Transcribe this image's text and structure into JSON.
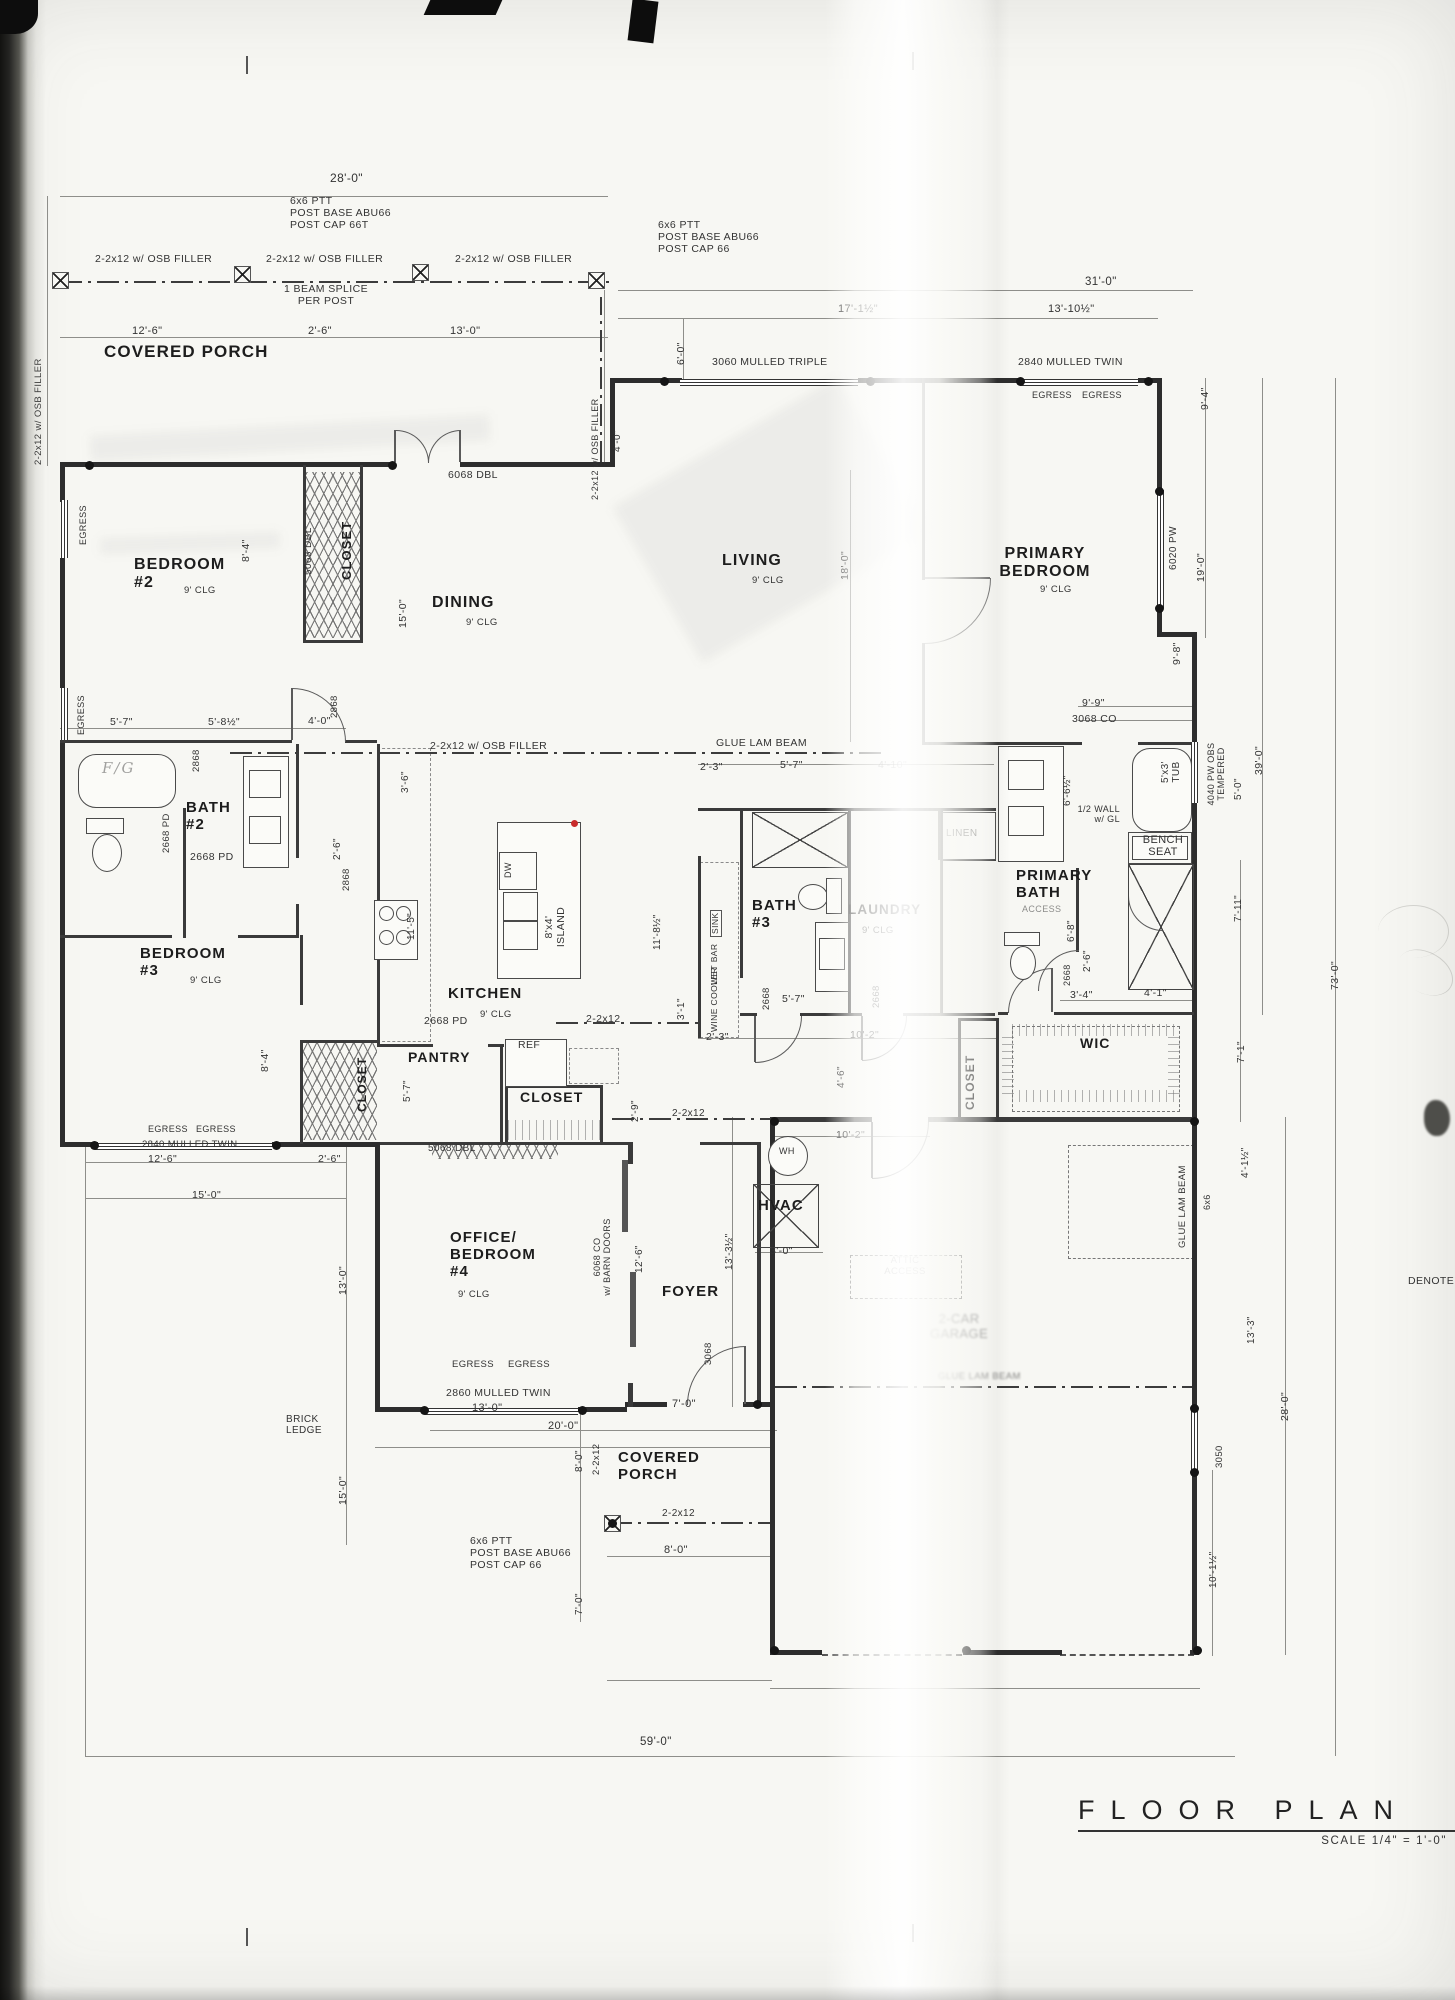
{
  "title_block": {
    "title": "FLOOR PLAN",
    "scale": "SCALE 1/4\" = 1'-0\""
  },
  "labels": [
    {
      "n": "dim-28-0",
      "t": "28'-0\"",
      "x": 330,
      "y": 172,
      "s": 12
    },
    {
      "n": "note-post-top-left",
      "t": "6x6 PTT\nPOST BASE ABU66\nPOST CAP 66T",
      "x": 290,
      "y": 196
    },
    {
      "n": "note-post-top-right",
      "t": "6x6 PTT\nPOST BASE ABU66\nPOST CAP 66",
      "x": 658,
      "y": 220
    },
    {
      "n": "note-osb-filler-1",
      "t": "2-2x12 w/ OSB FILLER",
      "x": 95,
      "y": 254
    },
    {
      "n": "note-osb-filler-2",
      "t": "2-2x12 w/ OSB FILLER",
      "x": 266,
      "y": 254
    },
    {
      "n": "note-osb-filler-3",
      "t": "2-2x12 w/ OSB FILLER",
      "x": 455,
      "y": 254
    },
    {
      "n": "note-beam-splice",
      "t": "1 BEAM SPLICE\nPER POST",
      "x": 278,
      "y": 284,
      "a": "center",
      "w": 96
    },
    {
      "n": "dim-31-0",
      "t": "31'-0\"",
      "x": 1085,
      "y": 276,
      "s": 11.5
    },
    {
      "n": "dim-17-1half",
      "t": "17'-1½\"",
      "x": 838,
      "y": 303,
      "s": 11
    },
    {
      "n": "dim-13-10half",
      "t": "13'-10½\"",
      "x": 1048,
      "y": 303,
      "s": 11
    },
    {
      "n": "room-covered-porch-top",
      "t": "COVERED PORCH",
      "x": 104,
      "y": 342,
      "s": 17,
      "c": "room"
    },
    {
      "n": "label-3060-mulled-triple",
      "t": "3060 MULLED TRIPLE",
      "x": 712,
      "y": 357
    },
    {
      "n": "label-2840-mulled-twin",
      "t": "2840 MULLED TWIN",
      "x": 1018,
      "y": 357
    },
    {
      "n": "label-egress-1",
      "t": "EGRESS",
      "x": 1032,
      "y": 390,
      "s": 9
    },
    {
      "n": "label-egress-2",
      "t": "EGRESS",
      "x": 1082,
      "y": 390,
      "s": 9
    },
    {
      "n": "dim-porch-12-6",
      "t": "12'-6\"",
      "x": 132,
      "y": 325,
      "s": 11
    },
    {
      "n": "dim-porch-2-6",
      "t": "2'-6\"",
      "x": 308,
      "y": 325,
      "s": 11
    },
    {
      "n": "dim-porch-13-0",
      "t": "13'-0\"",
      "x": 450,
      "y": 325,
      "s": 11
    },
    {
      "n": "label-6068-dbl",
      "t": "6068 DBL",
      "x": 448,
      "y": 470
    },
    {
      "n": "room-bedroom-2",
      "t": "BEDROOM\n#2",
      "x": 134,
      "y": 556,
      "s": 16,
      "c": "room"
    },
    {
      "n": "label-bedroom2-clg",
      "t": "9' CLG",
      "x": 184,
      "y": 586,
      "s": 9.5
    },
    {
      "n": "room-dining",
      "t": "DINING",
      "x": 432,
      "y": 594,
      "s": 16,
      "c": "room"
    },
    {
      "n": "label-dining-clg",
      "t": "9' CLG",
      "x": 466,
      "y": 618,
      "s": 9.5
    },
    {
      "n": "room-living",
      "t": "LIVING",
      "x": 722,
      "y": 552,
      "s": 16,
      "c": "room"
    },
    {
      "n": "label-living-clg",
      "t": "9' CLG",
      "x": 752,
      "y": 576,
      "s": 9.5
    },
    {
      "n": "room-primary-bedroom",
      "t": "PRIMARY\nBEDROOM",
      "x": 990,
      "y": 545,
      "s": 16,
      "c": "room",
      "a": "center",
      "w": 110
    },
    {
      "n": "label-primary-bedroom-clg",
      "t": "9' CLG",
      "x": 1040,
      "y": 585,
      "s": 9.5
    },
    {
      "n": "dim-5-7-bath2",
      "t": "5'-7\"",
      "x": 110,
      "y": 717
    },
    {
      "n": "dim-5-8half",
      "t": "5'-8½\"",
      "x": 208,
      "y": 717
    },
    {
      "n": "dim-4-0-bath2",
      "t": "4'-0\"",
      "x": 308,
      "y": 716
    },
    {
      "n": "label-glue-lam-beam-main",
      "t": "GLUE LAM BEAM",
      "x": 716,
      "y": 738
    },
    {
      "n": "note-osb-filler-mid",
      "t": "2-2x12 w/ OSB FILLER",
      "x": 430,
      "y": 741
    },
    {
      "n": "room-bath-2",
      "t": "BATH\n#2",
      "x": 186,
      "y": 800,
      "s": 15,
      "c": "room"
    },
    {
      "n": "label-2668-pd-h",
      "t": "2668 PD",
      "x": 190,
      "y": 852
    },
    {
      "n": "room-bedroom-3",
      "t": "BEDROOM\n#3",
      "x": 140,
      "y": 946,
      "s": 15,
      "c": "room"
    },
    {
      "n": "label-bedroom3-clg",
      "t": "9' CLG",
      "x": 190,
      "y": 976,
      "s": 9.5
    },
    {
      "n": "room-kitchen",
      "t": "KITCHEN",
      "x": 448,
      "y": 986,
      "s": 15,
      "c": "room"
    },
    {
      "n": "label-kitchen-clg",
      "t": "9' CLG",
      "x": 480,
      "y": 1010,
      "s": 9.5
    },
    {
      "n": "label-2668-pd-kitchen",
      "t": "2668 PD",
      "x": 424,
      "y": 1016
    },
    {
      "n": "label-2-2x12-kitchen",
      "t": "2-2x12",
      "x": 586,
      "y": 1014
    },
    {
      "n": "room-pantry",
      "t": "PANTRY",
      "x": 408,
      "y": 1050,
      "s": 14,
      "c": "room"
    },
    {
      "n": "label-ref",
      "t": "REF",
      "x": 518,
      "y": 1040
    },
    {
      "n": "room-closet-foyer",
      "t": "CLOSET",
      "x": 520,
      "y": 1090,
      "s": 14,
      "c": "room"
    },
    {
      "n": "label-5068-dbl-closet",
      "t": "5068 DBL",
      "x": 428,
      "y": 1143,
      "s": 10
    },
    {
      "n": "dim-2-3-a",
      "t": "2'-3\"",
      "x": 700,
      "y": 762
    },
    {
      "n": "dim-5-7-bath3",
      "t": "5'-7\"",
      "x": 780,
      "y": 760
    },
    {
      "n": "dim-4-10",
      "t": "4'-10\"",
      "x": 878,
      "y": 760,
      "c": "faint"
    },
    {
      "n": "room-bath-3",
      "t": "BATH\n#3",
      "x": 752,
      "y": 898,
      "s": 15,
      "c": "room"
    },
    {
      "n": "room-laundry",
      "t": "LAUNDRY",
      "x": 848,
      "y": 902,
      "s": 13.5,
      "c": "room"
    },
    {
      "n": "label-laundry-clg",
      "t": "9' CLG",
      "x": 862,
      "y": 926,
      "s": 9.5
    },
    {
      "n": "label-linen",
      "t": "LINEN",
      "x": 946,
      "y": 828,
      "s": 10,
      "c": "faint"
    },
    {
      "n": "dim-5-7-hall",
      "t": "5'-7\"",
      "x": 782,
      "y": 994
    },
    {
      "n": "dim-10-2-hall",
      "t": "10'-2\"",
      "x": 850,
      "y": 1030
    },
    {
      "n": "dim-2-3-b",
      "t": "2'-3\"",
      "x": 706,
      "y": 1032
    },
    {
      "n": "label-2-2x12-c",
      "t": "2-2x12",
      "x": 672,
      "y": 1108,
      "s": 10
    },
    {
      "n": "dim-9-9",
      "t": "9'-9\"",
      "x": 1082,
      "y": 698
    },
    {
      "n": "label-3068-co",
      "t": "3068 CO",
      "x": 1072,
      "y": 714
    },
    {
      "n": "note-half-wall",
      "t": "1/2 WALL\nw/ GL",
      "x": 1074,
      "y": 804,
      "s": 9,
      "a": "right",
      "w": 46
    },
    {
      "n": "label-bench-seat",
      "t": "BENCH\nSEAT",
      "x": 1134,
      "y": 834,
      "s": 11,
      "a": "center",
      "w": 58
    },
    {
      "n": "room-primary-bath",
      "t": "PRIMARY\nBATH",
      "x": 1016,
      "y": 868,
      "s": 15,
      "c": "room"
    },
    {
      "n": "label-access",
      "t": "ACCESS",
      "x": 1022,
      "y": 904,
      "s": 9,
      "c": "faint"
    },
    {
      "n": "dim-3-4",
      "t": "3'-4\"",
      "x": 1070,
      "y": 990
    },
    {
      "n": "dim-4-1",
      "t": "4'-1\"",
      "x": 1144,
      "y": 988
    },
    {
      "n": "room-wic",
      "t": "WIC",
      "x": 1080,
      "y": 1036,
      "s": 14,
      "c": "room"
    },
    {
      "n": "dim-10-2-garage",
      "t": "10'-2\"",
      "x": 836,
      "y": 1130
    },
    {
      "n": "label-wh",
      "t": "WH",
      "x": 779,
      "y": 1146,
      "s": 9
    },
    {
      "n": "room-hvac",
      "t": "HVAC",
      "x": 758,
      "y": 1198,
      "s": 15,
      "c": "room"
    },
    {
      "n": "dim-3-0-garage",
      "t": "3'-0\"",
      "x": 770,
      "y": 1246
    },
    {
      "n": "label-attic-access",
      "t": "ATTIC\nACCESS",
      "x": 874,
      "y": 1256,
      "s": 9.5,
      "c": "faint",
      "a": "center",
      "w": 62
    },
    {
      "n": "room-garage",
      "t": "2-CAR\nGARAGE",
      "x": 918,
      "y": 1312,
      "s": 13,
      "c": "blur",
      "a": "center",
      "w": 82
    },
    {
      "n": "label-glue-lam-garage",
      "t": "GLUE LAM BEAM",
      "x": 938,
      "y": 1372,
      "s": 9.5,
      "c": "blur"
    },
    {
      "n": "note-brick-ledge",
      "t": "BRICK\nLEDGE",
      "x": 286,
      "y": 1414,
      "s": 10
    },
    {
      "n": "label-egress-office-1",
      "t": "EGRESS",
      "x": 452,
      "y": 1360,
      "s": 9.5
    },
    {
      "n": "label-egress-office-2",
      "t": "EGRESS",
      "x": 508,
      "y": 1360,
      "s": 9.5
    },
    {
      "n": "label-2860-office",
      "t": "2860 MULLED TWIN",
      "x": 446,
      "y": 1388
    },
    {
      "n": "dim-13-0-office",
      "t": "13'-0\"",
      "x": 472,
      "y": 1402,
      "s": 11
    },
    {
      "n": "dim-20-0",
      "t": "20'-0\"",
      "x": 548,
      "y": 1420,
      "s": 11
    },
    {
      "n": "dim-7-0-porch",
      "t": "7'-0\"",
      "x": 672,
      "y": 1398,
      "s": 11
    },
    {
      "n": "room-office",
      "t": "OFFICE/\nBEDROOM\n#4",
      "x": 450,
      "y": 1230,
      "s": 15,
      "c": "room"
    },
    {
      "n": "label-office-clg",
      "t": "9' CLG",
      "x": 458,
      "y": 1290,
      "s": 9.5
    },
    {
      "n": "room-foyer",
      "t": "FOYER",
      "x": 662,
      "y": 1284,
      "s": 15,
      "c": "room"
    },
    {
      "n": "room-covered-porch-bottom",
      "t": "COVERED\nPORCH",
      "x": 618,
      "y": 1450,
      "s": 15,
      "c": "room"
    },
    {
      "n": "label-2-2x12-porch-line",
      "t": "2-2x12",
      "x": 662,
      "y": 1508,
      "s": 10
    },
    {
      "n": "note-post-bottom",
      "t": "6x6 PTT\nPOST BASE ABU66\nPOST CAP 66",
      "x": 470,
      "y": 1536
    },
    {
      "n": "dim-8-0-porch",
      "t": "8'-0\"",
      "x": 664,
      "y": 1544,
      "s": 11
    },
    {
      "n": "dim-59-0",
      "t": "59'-0\"",
      "x": 640,
      "y": 1736,
      "s": 11.5
    },
    {
      "n": "label-denote",
      "t": "DENOTE",
      "x": 1408,
      "y": 1276
    },
    {
      "n": "dim-12-6-bottom",
      "t": "12'-6\"",
      "x": 148,
      "y": 1154
    },
    {
      "n": "label-egress-b3-1",
      "t": "EGRESS",
      "x": 148,
      "y": 1124,
      "s": 9
    },
    {
      "n": "label-egress-b3-2",
      "t": "EGRESS",
      "x": 196,
      "y": 1124,
      "s": 9
    },
    {
      "n": "label-2840-b3",
      "t": "2840 MULLED TWIN",
      "x": 142,
      "y": 1140,
      "s": 9.5
    },
    {
      "n": "dim-15-0-bottom",
      "t": "15'-0\"",
      "x": 192,
      "y": 1190
    },
    {
      "n": "dim-2-6-bottom",
      "t": "2'-6\"",
      "x": 318,
      "y": 1154
    },
    {
      "n": "label-fg-handwritten",
      "t": "F/G",
      "x": 102,
      "y": 760,
      "s": 15,
      "c": "hand"
    },
    {
      "n": "note-osb-left-vert",
      "t": "2-2x12 w/ OSB FILLER",
      "x": 34,
      "y": 465,
      "r": -90,
      "s": 9.5
    },
    {
      "n": "label-egress-left-1",
      "t": "EGRESS",
      "x": 78,
      "y": 545,
      "r": -90,
      "s": 9
    },
    {
      "n": "label-egress-left-2",
      "t": "EGRESS",
      "x": 76,
      "y": 735,
      "r": -90,
      "s": 9
    },
    {
      "n": "dim-6-0-top",
      "t": "6'-0\"",
      "x": 676,
      "y": 365,
      "r": -90
    },
    {
      "n": "label-5068-dbl-b2",
      "t": "5068 DBL",
      "x": 303,
      "y": 575,
      "r": -90,
      "s": 10
    },
    {
      "n": "dim-8-4-b2",
      "t": "8'-4\"",
      "x": 241,
      "y": 562,
      "r": -90
    },
    {
      "n": "room-closet-b2",
      "t": "CLOSET",
      "x": 340,
      "y": 580,
      "r": -90,
      "s": 13,
      "c": "room"
    },
    {
      "n": "dim-15-0-dining",
      "t": "15'-0\"",
      "x": 398,
      "y": 628,
      "r": -90
    },
    {
      "n": "note-osb-vert-mid",
      "t": "2-2x12 w/ OSB FILLER",
      "x": 590,
      "y": 500,
      "r": -90,
      "s": 9
    },
    {
      "n": "dim-4-0-jog",
      "t": "4'-0\"",
      "x": 612,
      "y": 452,
      "r": -90,
      "s": 10
    },
    {
      "n": "dim-18-0-living",
      "t": "18'-0\"",
      "x": 840,
      "y": 580,
      "r": -90
    },
    {
      "n": "dim-9-4-right",
      "t": "9'-4\"",
      "x": 1200,
      "y": 410,
      "r": -90
    },
    {
      "n": "label-6020-pw",
      "t": "6020 PW",
      "x": 1168,
      "y": 570,
      "r": -90,
      "s": 10
    },
    {
      "n": "dim-19-0-right",
      "t": "19'-0\"",
      "x": 1196,
      "y": 582,
      "r": -90
    },
    {
      "n": "dim-9-8-right",
      "t": "9'-8\"",
      "x": 1172,
      "y": 665,
      "r": -90
    },
    {
      "n": "dim-2868-hall-a",
      "t": "2868",
      "x": 192,
      "y": 772,
      "r": -90,
      "s": 9.5
    },
    {
      "n": "label-2668-pd-v",
      "t": "2668 PD",
      "x": 162,
      "y": 853,
      "r": -90,
      "s": 9.5
    },
    {
      "n": "dim-2868-dining",
      "t": "2868",
      "x": 330,
      "y": 718,
      "r": -90,
      "s": 9.5
    },
    {
      "n": "dim-3-6-hall",
      "t": "3'-6\"",
      "x": 400,
      "y": 793,
      "r": -90,
      "s": 10
    },
    {
      "n": "dim-2-6-hall",
      "t": "2'-6\"",
      "x": 332,
      "y": 860,
      "r": -90,
      "s": 10
    },
    {
      "n": "dim-2868-hall-b",
      "t": "2868",
      "x": 342,
      "y": 891,
      "r": -90,
      "s": 9.5
    },
    {
      "n": "dim-11-5",
      "t": "11'-5\"",
      "x": 406,
      "y": 940,
      "r": -90,
      "s": 10
    },
    {
      "n": "label-dw",
      "t": "DW",
      "x": 503,
      "y": 878,
      "r": -90,
      "s": 9
    },
    {
      "n": "label-island",
      "t": "8'x4'\nISLAND",
      "x": 544,
      "y": 968,
      "r": -90,
      "a": "center",
      "w": 82
    },
    {
      "n": "dim-11-8half",
      "t": "11'-8½\"",
      "x": 652,
      "y": 950,
      "r": -90,
      "s": 10
    },
    {
      "n": "label-sink",
      "t": "SINK",
      "x": 710,
      "y": 937,
      "r": -90,
      "s": 8.5,
      "c": "boxed"
    },
    {
      "n": "label-wet-bar",
      "t": "WET BAR",
      "x": 710,
      "y": 985,
      "r": -90,
      "s": 8.5
    },
    {
      "n": "label-wine-cooler",
      "t": "WINE COOLER",
      "x": 710,
      "y": 1032,
      "r": -90,
      "s": 8.5
    },
    {
      "n": "dim-3-1",
      "t": "3'-1\"",
      "x": 676,
      "y": 1020,
      "r": -90,
      "s": 10
    },
    {
      "n": "dim-2-9",
      "t": "2'-9\"",
      "x": 630,
      "y": 1122,
      "r": -90,
      "s": 10
    },
    {
      "n": "dim-2668-bath3",
      "t": "2668",
      "x": 762,
      "y": 1010,
      "r": -90,
      "s": 9.5
    },
    {
      "n": "dim-2668-laundry",
      "t": "2668",
      "x": 872,
      "y": 1008,
      "r": -90,
      "s": 9.5
    },
    {
      "n": "dim-4-6-hall",
      "t": "4'-6\"",
      "x": 836,
      "y": 1088,
      "r": -90,
      "s": 10
    },
    {
      "n": "room-closet-hall",
      "t": "CLOSET",
      "x": 964,
      "y": 1110,
      "r": -90,
      "s": 12,
      "c": "room"
    },
    {
      "n": "dim-6-6half",
      "t": "6'-6½\"",
      "x": 1062,
      "y": 806,
      "r": -90,
      "s": 10
    },
    {
      "n": "label-tub-5x3",
      "t": "5'x3'\nTUB",
      "x": 1160,
      "y": 800,
      "r": -90,
      "s": 10,
      "a": "center",
      "w": 56
    },
    {
      "n": "label-4040-pw",
      "t": "4040 PW OBS\nTEMPERED",
      "x": 1206,
      "y": 808,
      "r": -90,
      "s": 9,
      "a": "center",
      "w": 68
    },
    {
      "n": "dim-5-0-bath",
      "t": "5'-0\"",
      "x": 1233,
      "y": 800,
      "r": -90,
      "s": 10
    },
    {
      "n": "dim-39-0",
      "t": "39'-0\"",
      "x": 1254,
      "y": 775,
      "r": -90
    },
    {
      "n": "dim-6-8",
      "t": "6'-8\"",
      "x": 1066,
      "y": 942,
      "r": -90,
      "s": 10
    },
    {
      "n": "dim-2-6-bath",
      "t": "2'-6\"",
      "x": 1082,
      "y": 972,
      "r": -90,
      "s": 10
    },
    {
      "n": "dim-2668-primary",
      "t": "2668",
      "x": 1062,
      "y": 986,
      "r": -90,
      "s": 9
    },
    {
      "n": "dim-7-11",
      "t": "7'-11\"",
      "x": 1233,
      "y": 922,
      "r": -90,
      "s": 10
    },
    {
      "n": "dim-7-1-wic",
      "t": "7'-1\"",
      "x": 1236,
      "y": 1063,
      "r": -90,
      "s": 10
    },
    {
      "n": "label-glue-lam-vert",
      "t": "GLUE LAM BEAM",
      "x": 1178,
      "y": 1248,
      "r": -90,
      "s": 9.5
    },
    {
      "n": "label-6x6",
      "t": "6x6",
      "x": 1202,
      "y": 1210,
      "r": -90,
      "s": 9
    },
    {
      "n": "dim-4-1half-right",
      "t": "4'-1½\"",
      "x": 1240,
      "y": 1178,
      "r": -90,
      "s": 10
    },
    {
      "n": "dim-13-3-right",
      "t": "13'-3\"",
      "x": 1246,
      "y": 1344,
      "r": -90,
      "s": 10
    },
    {
      "n": "label-3050",
      "t": "3050",
      "x": 1215,
      "y": 1468,
      "r": -90,
      "s": 9.5
    },
    {
      "n": "dim-10-1half",
      "t": "10'-1½\"",
      "x": 1208,
      "y": 1588,
      "r": -90,
      "s": 10
    },
    {
      "n": "dim-28-0-right",
      "t": "28'-0\"",
      "x": 1280,
      "y": 1421,
      "r": -90
    },
    {
      "n": "dim-73-0",
      "t": "73'-0\"",
      "x": 1330,
      "y": 990,
      "r": -90
    },
    {
      "n": "dim-8-4-b3",
      "t": "8'-4\"",
      "x": 260,
      "y": 1072,
      "r": -90
    },
    {
      "n": "room-closet-b3",
      "t": "CLOSET",
      "x": 356,
      "y": 1112,
      "r": -90,
      "s": 12,
      "c": "room"
    },
    {
      "n": "dim-5-7-pantry",
      "t": "5'-7\"",
      "x": 402,
      "y": 1102,
      "r": -90,
      "s": 10
    },
    {
      "n": "dim-13-0-left",
      "t": "13'-0\"",
      "x": 338,
      "y": 1295,
      "r": -90
    },
    {
      "n": "dim-15-0-left",
      "t": "15'-0\"",
      "x": 338,
      "y": 1505,
      "r": -90
    },
    {
      "n": "label-6068-barn",
      "t": "6068 CO\nw/ BARN DOORS",
      "x": 592,
      "y": 1305,
      "r": -90,
      "s": 9,
      "a": "center",
      "w": 96
    },
    {
      "n": "dim-12-6-barn",
      "t": "12'-6\"",
      "x": 634,
      "y": 1273,
      "r": -90,
      "s": 10
    },
    {
      "n": "dim-13-3half",
      "t": "13'-3½\"",
      "x": 724,
      "y": 1270,
      "r": -90,
      "s": 10
    },
    {
      "n": "dim-3068-foyer",
      "t": "3068",
      "x": 704,
      "y": 1365,
      "r": -90,
      "s": 9.5
    },
    {
      "n": "dim-8-0-v",
      "t": "8'-0\"",
      "x": 574,
      "y": 1472,
      "r": -90,
      "s": 10
    },
    {
      "n": "label-2-2x12-v",
      "t": "2-2x12",
      "x": 592,
      "y": 1475,
      "r": -90,
      "s": 9.5
    },
    {
      "n": "dim-7-0-v",
      "t": "7'-0\"",
      "x": 574,
      "y": 1615,
      "r": -90,
      "s": 10
    }
  ]
}
